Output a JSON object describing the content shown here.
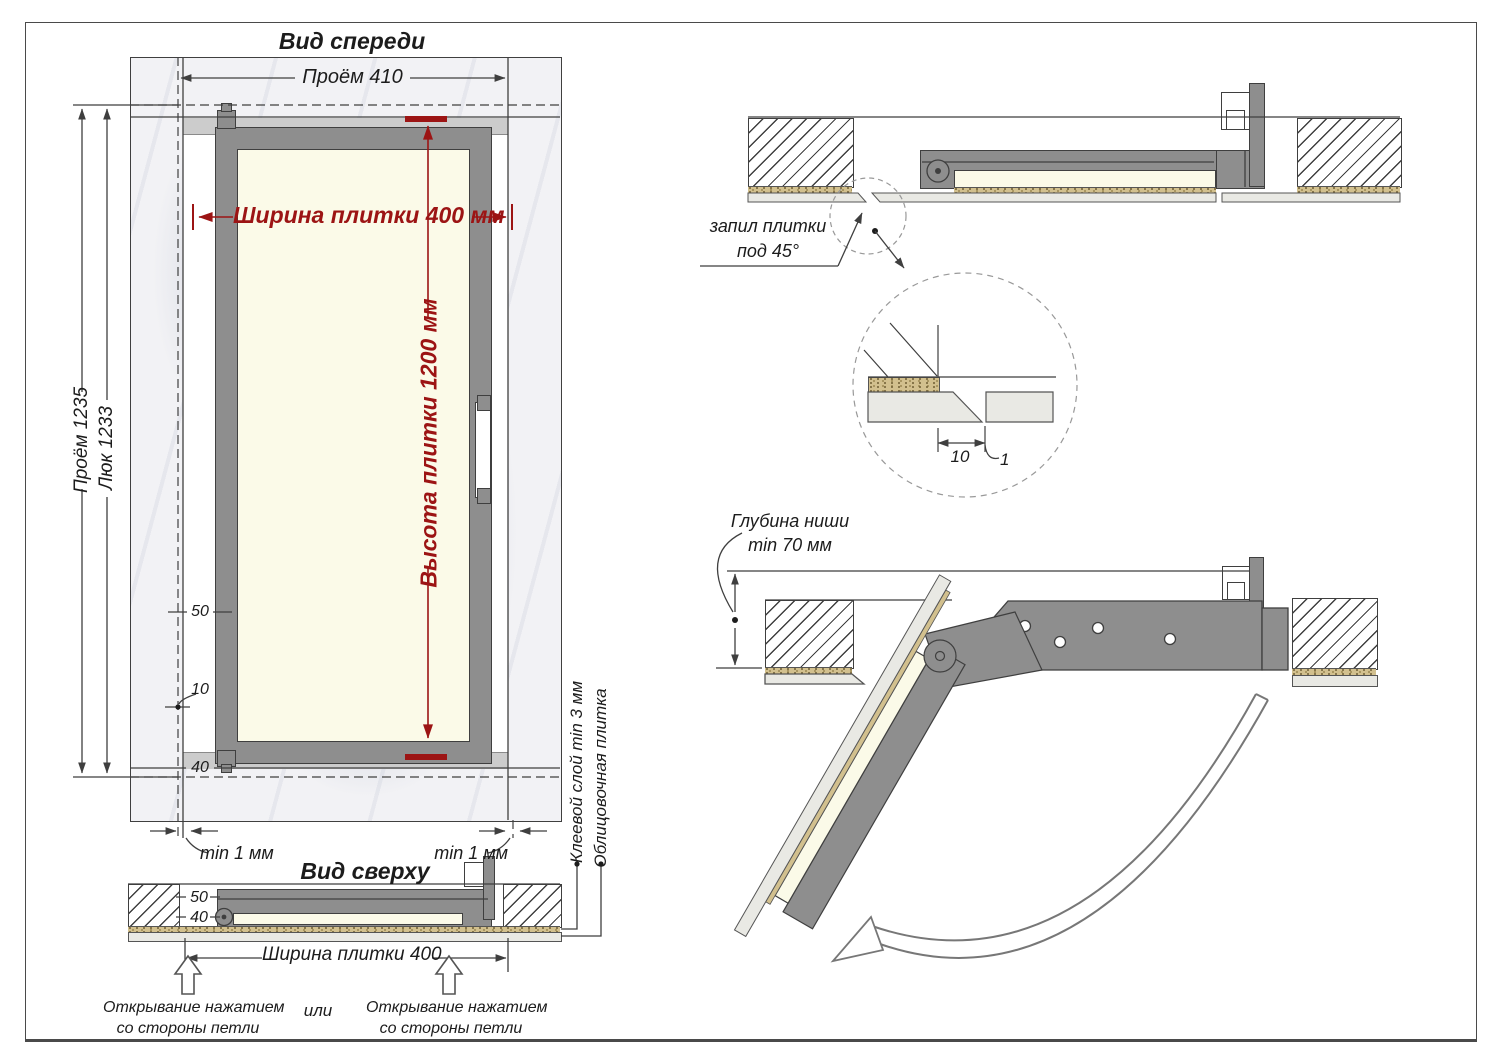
{
  "front_view": {
    "title": "Вид спереди",
    "dims": {
      "opening_width": "Проём 410",
      "opening_height": "Проём 1235",
      "hatch_height": "Люк 1233",
      "tile_width": "Ширина плитки 400 мм",
      "tile_height": "Высота плитки 1200 мм",
      "offset_50": "50",
      "offset_10": "10",
      "offset_40": "40",
      "gap_left": "min 1 мм",
      "gap_right": "min 1 мм"
    },
    "layer_labels": {
      "glue": "Клеевой слой min 3 мм",
      "tile": "Облицовочная плитка"
    }
  },
  "top_view": {
    "title": "Вид сверху",
    "dims": {
      "offset_50": "50",
      "offset_40": "40",
      "tile_width": "Ширина плитки 400"
    },
    "open_hint_left": {
      "line1": "Открывание нажатием",
      "line2": "со стороны петли"
    },
    "or_label": "или",
    "open_hint_right": {
      "line1": "Открывание нажатием",
      "line2": "со стороны петли"
    }
  },
  "closed_section": {
    "cut_label": {
      "line1": "запил плитки",
      "line2": "под 45°"
    },
    "detail": {
      "dim_10": "10",
      "dim_1": "1"
    }
  },
  "open_section": {
    "depth_label": {
      "line1": "Глубина ниши",
      "line2": "min 70 мм"
    }
  },
  "colors": {
    "accent_red": "#9c1414",
    "frame_gray": "#8e8e8e",
    "tile_cream": "#fbfae8",
    "adhesive_tan": "#d2c08e",
    "facing_tile": "#e9e9e4",
    "marble": "#f2f2f5",
    "line": "#3f3f3f"
  }
}
